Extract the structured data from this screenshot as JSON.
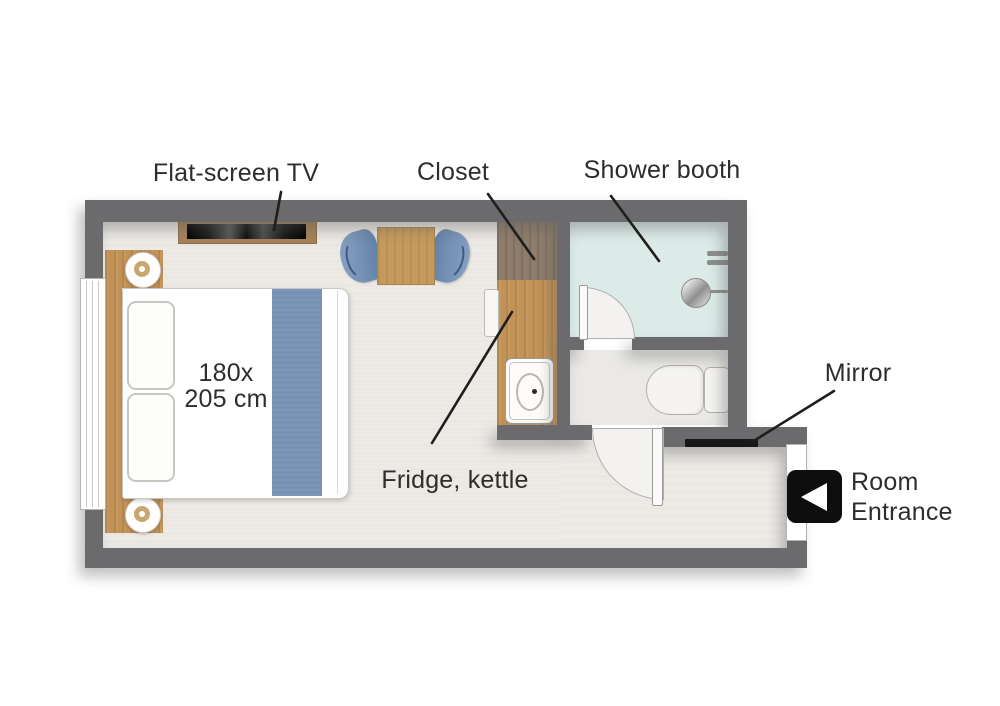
{
  "labels": {
    "flat_screen_tv": "Flat-screen TV",
    "closet": "Closet",
    "shower_booth": "Shower booth",
    "mirror": "Mirror",
    "fridge_kettle": "Fridge, kettle",
    "room_entrance": {
      "line1": "Room",
      "line2": "Entrance"
    },
    "bed_size": {
      "line1": "180x",
      "line2": "205 cm"
    }
  },
  "colors": {
    "wall": "#6b6a6c",
    "floor": "#edeae6",
    "shower_floor": "#dcebe8",
    "bathroom_floor": "#eae9e7",
    "wood_light": "#c29257",
    "wood_dark": "#8e7d6c",
    "accent_blue": "#7691b4",
    "label_text": "#2d2d2d",
    "entrance_icon_bg": "#0e0e0e",
    "mirror_bar": "#181818"
  },
  "icons": {
    "entrance": "arrow-left-icon"
  }
}
